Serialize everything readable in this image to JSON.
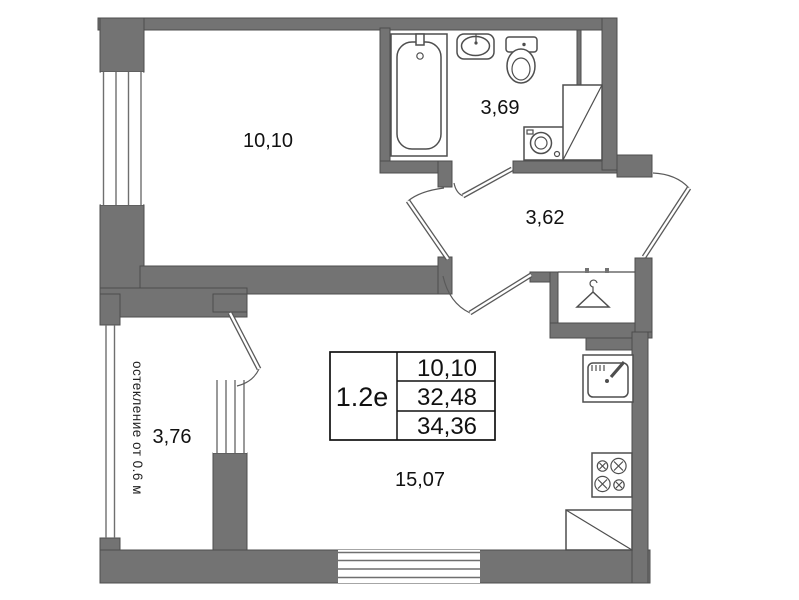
{
  "plan": {
    "unit": {
      "type_label": "1.2e",
      "areas": {
        "room": "10,10",
        "living": "32,48",
        "total": "34,36"
      }
    },
    "rooms": {
      "bedroom": {
        "area": "10,10"
      },
      "bathroom": {
        "area": "3,69"
      },
      "hallway": {
        "area": "3,62"
      },
      "balcony": {
        "area": "3,76",
        "note": "остекление от 0.6 м"
      },
      "living_kitchen": {
        "area": "15,07"
      }
    },
    "fixture_icons": [
      "bathtub-icon",
      "sink-icon",
      "toilet-icon",
      "washing-machine-icon",
      "duct-cabinet-icon",
      "wardrobe-hanger-icon",
      "kitchen-sink-icon",
      "stove-icon",
      "counter-icon"
    ],
    "colors": {
      "wall": "#737373",
      "outline": "#4d4d4d",
      "background": "#ffffff",
      "text": "#111111"
    }
  }
}
